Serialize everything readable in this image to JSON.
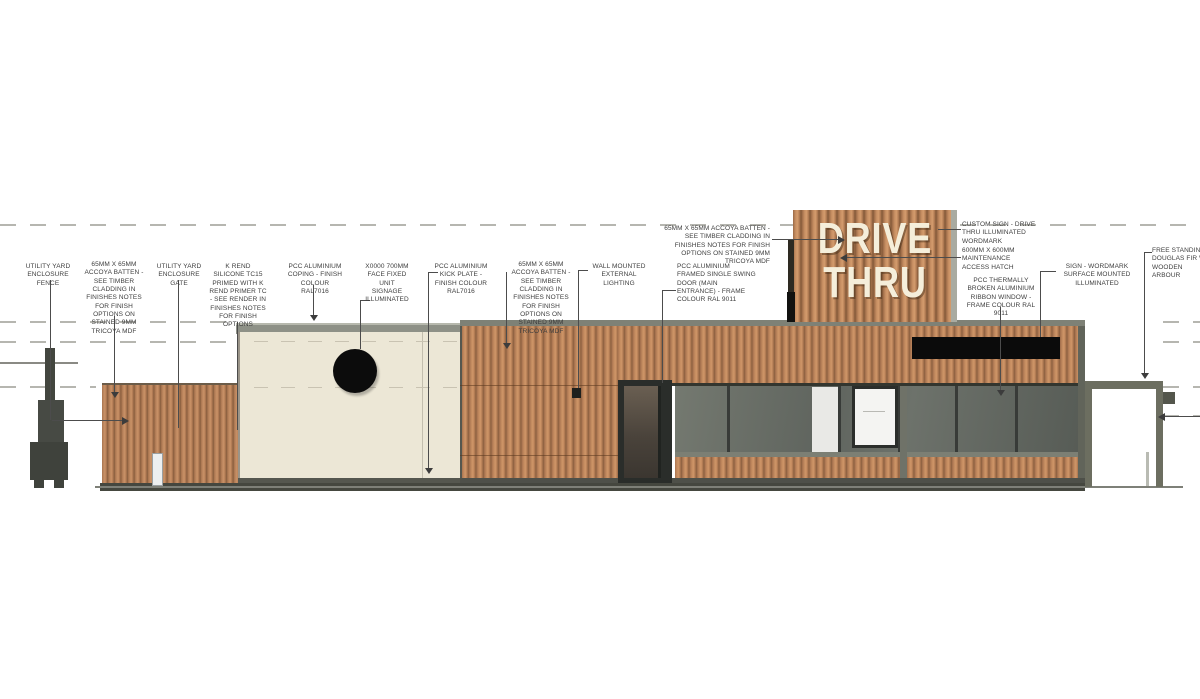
{
  "title": "Drive-thru restaurant elevation drawing",
  "tower": {
    "line1": "DRIVE",
    "line2": "THRU"
  },
  "colors": {
    "timber": "#b5805a",
    "timber_dark": "#8a5f3f",
    "render": "#ece7d6",
    "coping_grey": "#8e9187",
    "glass": "#646962",
    "frame_dark": "#2b2e2b",
    "sign_band_black": "#0b0b0b",
    "wordmark_cream": "#f5eeda",
    "ground_grey": "#7e8078"
  },
  "annotations": [
    {
      "name": "utility-yard-enclosure-fence",
      "text": "UTILITY YARD ENCLOSURE FENCE"
    },
    {
      "name": "accoya-batten-1",
      "text": "65MM X 65MM ACCOYA BATTEN - SEE TIMBER CLADDING IN FINISHES NOTES FOR FINISH OPTIONS ON STAINED 9MM TRICOYA MDF"
    },
    {
      "name": "utility-yard-enclosure-gate",
      "text": "UTILITY YARD ENCLOSURE GATE"
    },
    {
      "name": "k-rend",
      "text": "K REND SILICONE TC15 PRIMED WITH K REND PRIMER TC - SEE RENDER IN FINISHES NOTES FOR FINISH OPTIONS"
    },
    {
      "name": "coping",
      "text": "PCC ALUMINIUM COPING - FINISH COLOUR RAL7016"
    },
    {
      "name": "unit-signage",
      "text": "X0000 700MM FACE FIXED UNIT SIGNAGE ILLUMINATED"
    },
    {
      "name": "kick-plate",
      "text": "PCC ALUMINIUM KICK PLATE - FINISH COLOUR RAL7016"
    },
    {
      "name": "accoya-batten-2",
      "text": "65MM X 65MM ACCOYA BATTEN - SEE TIMBER CLADDING IN FINISHES NOTES FOR FINISH OPTIONS ON STAINED 9MM TRICOYA MDF"
    },
    {
      "name": "wall-lighting",
      "text": "WALL MOUNTED EXTERNAL LIGHTING"
    },
    {
      "name": "entrance-door",
      "text": "PCC ALUMINIUM FRAMED SINGLE SWING DOOR (MAIN ENTRANCE) - FRAME COLOUR RAL 9011"
    },
    {
      "name": "accoya-batten-3",
      "text": "65MM X 65MM ACCOYA BATTEN - SEE TIMBER CLADDING IN FINISHES NOTES FOR FINISH OPTIONS ON STAINED 9MM TRICOYA MDF"
    },
    {
      "name": "custom-sign",
      "text": "CUSTOM SIGN - DRIVE THRU ILLUMINATED WORDMARK"
    },
    {
      "name": "access-hatch",
      "text": "600MM X 600MM MAINTENANCE ACCESS HATCH"
    },
    {
      "name": "ribbon-window",
      "text": "PCC THERMALLY BROKEN ALUMINIUM RIBBON WINDOW - FRAME COLOUR RAL 9011"
    },
    {
      "name": "sign-wordmark",
      "text": "SIGN - WORDMARK SURFACE MOUNTED ILLUMINATED"
    },
    {
      "name": "free-standing",
      "text": "FREE STANDING DOUGLAS FIR W WOODEN ARBOUR"
    }
  ]
}
